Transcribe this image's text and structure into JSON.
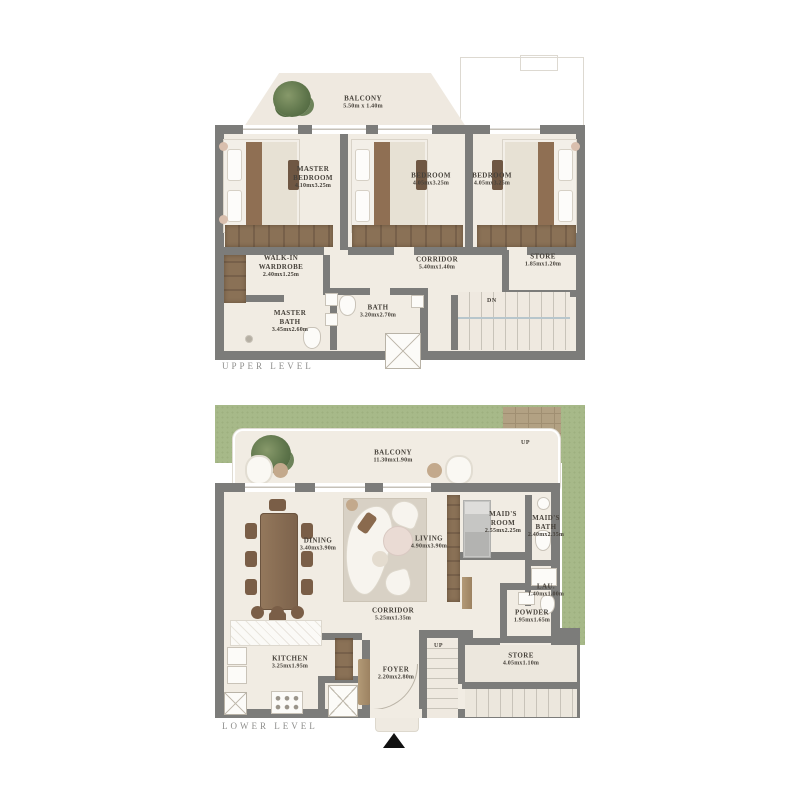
{
  "colors": {
    "wall": "#7c7c7a",
    "floor": "#f1ece3",
    "wood": "#8a7156",
    "grass": "#a7b989",
    "patio": "#b2a183",
    "label_text": "#46413a",
    "level_text": "#8e8e8c",
    "entry_marker": "#111111"
  },
  "upper": {
    "level_label": "UPPER LEVEL",
    "balcony": {
      "name": "BALCONY",
      "dims": "5.50m x 1.40m"
    },
    "master_bedroom": {
      "name": "MASTER BEDROOM",
      "dims": "4.10mx3.25m"
    },
    "bedroom_2": {
      "name": "BEDROOM",
      "dims": "4.05mx3.25m"
    },
    "bedroom_3": {
      "name": "BEDROOM",
      "dims": "4.05mx3.25m"
    },
    "walk_in_wardrobe": {
      "name": "WALK-IN WARDROBE",
      "dims": "2.40mx1.25m"
    },
    "corridor": {
      "name": "CORRIDOR",
      "dims": "5.40mx1.40m"
    },
    "store": {
      "name": "STORE",
      "dims": "1.85mx1.20m"
    },
    "master_bath": {
      "name": "MASTER BATH",
      "dims": "3.45mx2.60m"
    },
    "bath": {
      "name": "BATH",
      "dims": "3.20mx2.70m"
    },
    "stairs_down_label": "DN"
  },
  "lower": {
    "level_label": "LOWER LEVEL",
    "balcony": {
      "name": "BALCONY",
      "dims": "11.30mx1.90m"
    },
    "dining": {
      "name": "DINING",
      "dims": "3.40mx3.90m"
    },
    "living": {
      "name": "LIVING",
      "dims": "4.90mx3.90m"
    },
    "maids_room": {
      "name": "MAID'S ROOM",
      "dims": "2.55mx2.25m"
    },
    "maids_bath": {
      "name": "MAID'S BATH",
      "dims": "2.40mx2.35m"
    },
    "laundry": {
      "name": "LAU.",
      "dims": "1.40mx1.00m"
    },
    "corridor": {
      "name": "CORRIDOR",
      "dims": "5.25mx1.35m"
    },
    "powder": {
      "name": "POWDER",
      "dims": "1.95mx1.65m"
    },
    "store": {
      "name": "STORE",
      "dims": "4.05mx1.10m"
    },
    "kitchen": {
      "name": "KITCHEN",
      "dims": "3.25mx1.95m"
    },
    "foyer": {
      "name": "FOYER",
      "dims": "2.20mx2.80m"
    },
    "stairs_up_inner_label": "UP",
    "stairs_up_garden_label": "UP"
  }
}
